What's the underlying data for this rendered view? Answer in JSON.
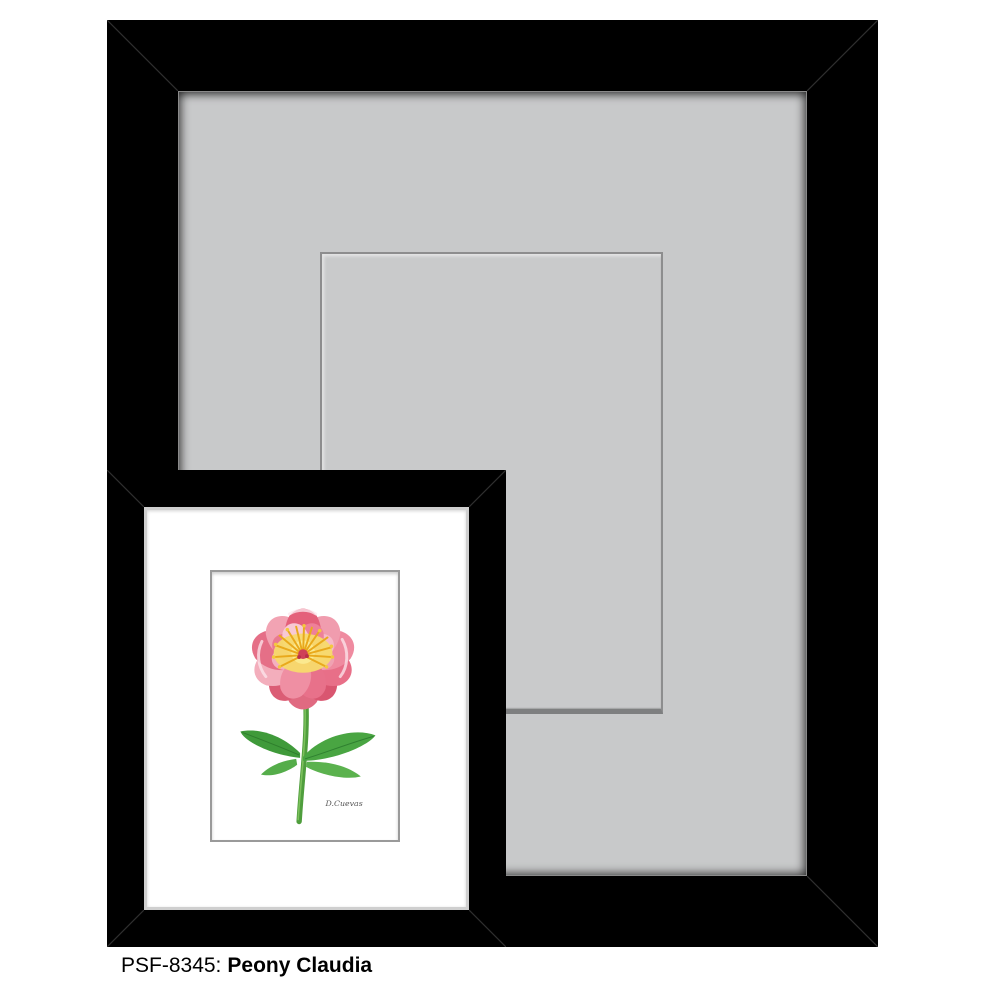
{
  "product": {
    "sku_label": "PSF-8345:",
    "name": "Peony Claudia"
  },
  "artwork": {
    "signature": "D.Cuevas",
    "subject": "peony-flower"
  },
  "colors": {
    "frame_black": "#000000",
    "mat_gray": "#c8c9ca",
    "mat_shadow": "#8a8a8a",
    "inner_mat_white": "#ffffff",
    "petal_light_pink": "#f5b7c4",
    "petal_mid_pink": "#ee8099",
    "petal_deep_coral": "#d95670",
    "stamen_yellow": "#e9a91c",
    "stamen_glow": "#f7da6b",
    "center_red": "#cf4058",
    "leaf_green": "#49a542",
    "stem_green": "#4f9e3d",
    "caption_text": "#000000"
  }
}
